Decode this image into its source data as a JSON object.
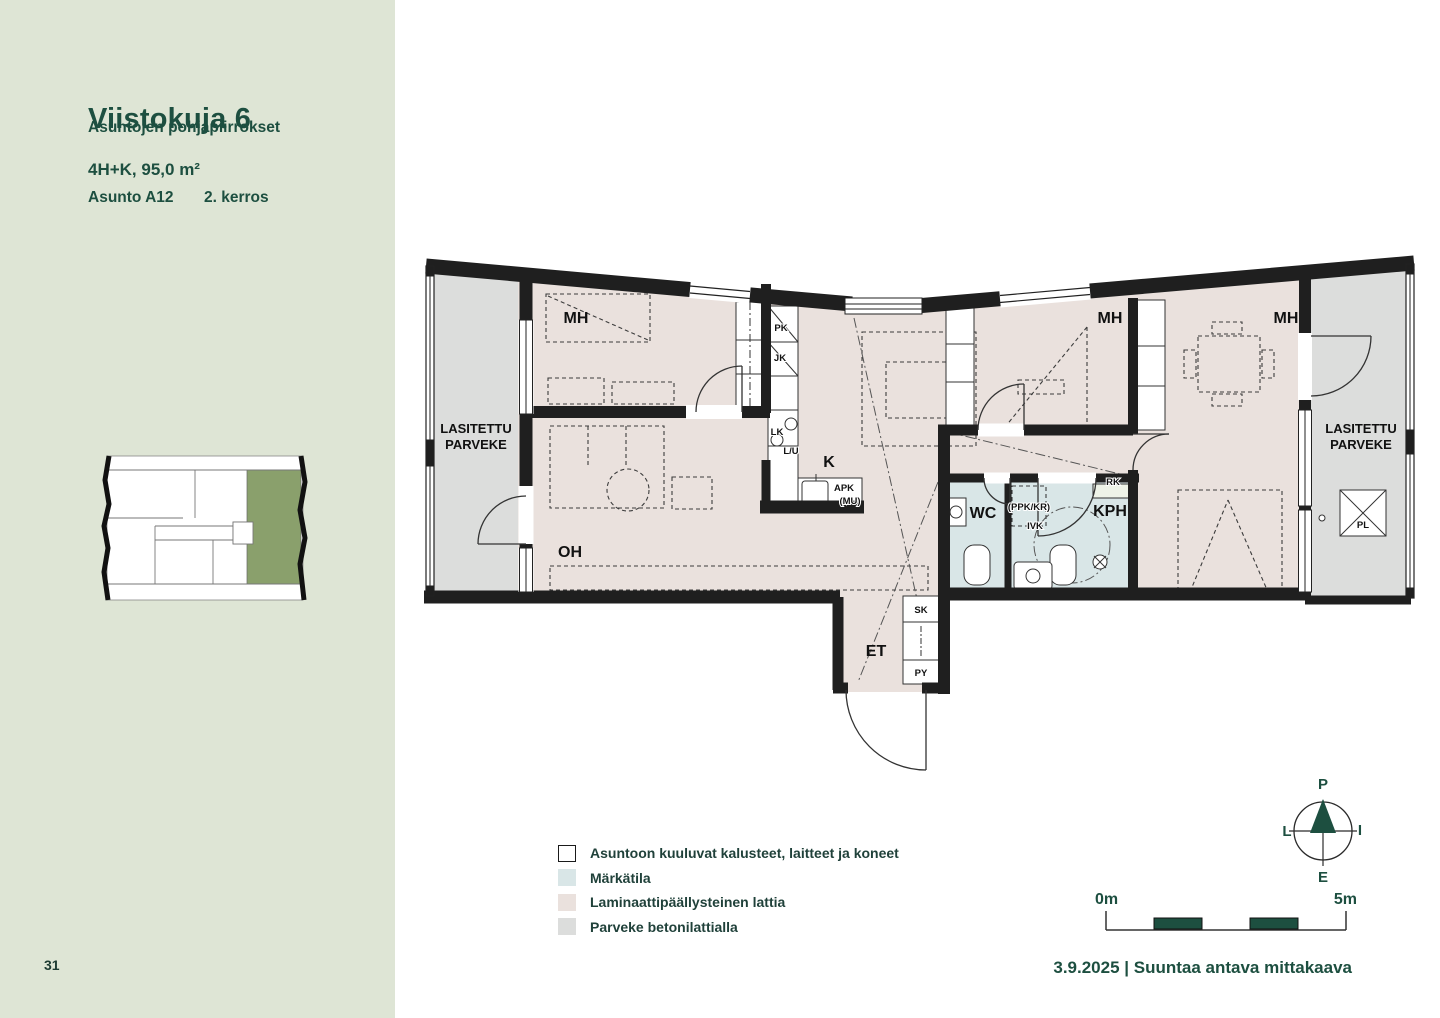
{
  "sidebar": {
    "title": "Viistokuja 6",
    "subtitle": "Asuntojen pohjapiirrokset",
    "apartment_type": "4H+K, 95,0 m²",
    "apartment_id": "Asunto A12",
    "floor": "2. kerros",
    "page_number": "31"
  },
  "plan": {
    "rooms": {
      "mh1": "MH",
      "mh2": "MH",
      "mh3": "MH",
      "oh": "OH",
      "k": "K",
      "et": "ET",
      "wc": "WC",
      "kph": "KPH"
    },
    "balcony_left": {
      "line1": "LASITETTU",
      "line2": "PARVEKE"
    },
    "balcony_right": {
      "line1": "LASITETTU",
      "line2": "PARVEKE"
    },
    "fixtures": {
      "pk": "PK",
      "jk": "JK",
      "lk": "LK",
      "lu": "L/U",
      "apk": "APK",
      "mu": "(MU)",
      "sk": "SK",
      "py": "PY",
      "rk": "RK",
      "ppk_kr": "(PPK/KR)",
      "ivk": "IVK",
      "pl": "PL"
    }
  },
  "legend": {
    "items": [
      {
        "label": "Asuntoon kuuluvat kalusteet, laitteet ja koneet",
        "swatch": "#ffffff"
      },
      {
        "label": "Märkätila",
        "swatch": "#d9e6e7"
      },
      {
        "label": "Laminaattipäällysteinen lattia",
        "swatch": "#eae1dd"
      },
      {
        "label": "Parveke betonilattialla",
        "swatch": "#dcdddc"
      }
    ]
  },
  "compass": {
    "north": "P",
    "east": "I",
    "south": "E",
    "west": "L"
  },
  "scale_bar": {
    "start": "0m",
    "end": "5m"
  },
  "footer": {
    "date_note": "3.9.2025 | Suuntaa antava mittakaava"
  },
  "colors": {
    "accent_green": "#1d4f40",
    "sidebar_bg": "#dee5d5",
    "floor_laminate": "#eae1dd",
    "wet_room": "#d9e6e7",
    "balcony_floor": "#dcdddc",
    "wall": "#1f1f1f",
    "keyplan_highlight": "#8aa06c"
  }
}
